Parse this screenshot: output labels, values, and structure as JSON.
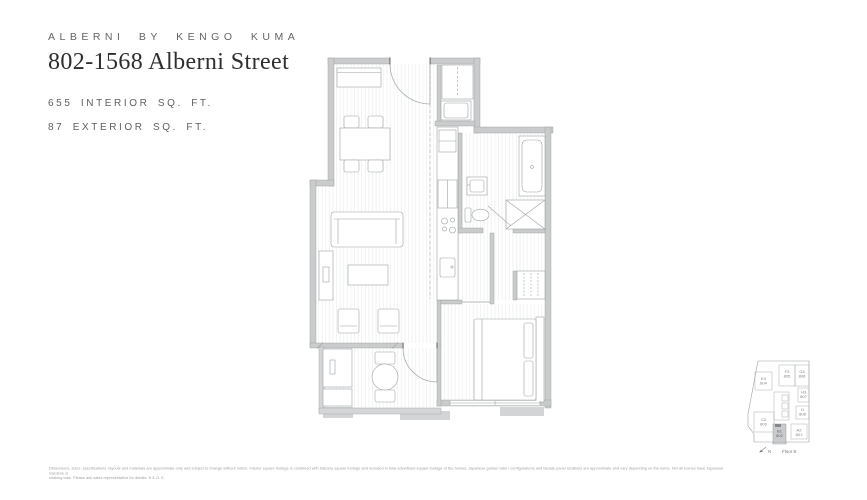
{
  "header": {
    "brand": "ALBERNI BY KENGO KUMA",
    "title": "802-1568 Alberni Street",
    "interior_sqft": "655 INTERIOR SQ. FT.",
    "exterior_sqft": "87 EXTERIOR SQ. FT."
  },
  "keyplan": {
    "north_label": "N",
    "floor_label": "Floor 8",
    "highlighted_unit": "B1 802",
    "units": [
      {
        "code": "E4",
        "number": "804"
      },
      {
        "code": "F3",
        "number": "805"
      },
      {
        "code": "G4",
        "number": "806"
      },
      {
        "code": "H3",
        "number": "807"
      },
      {
        "code": "I1",
        "number": "808"
      },
      {
        "code": "C2",
        "number": "803"
      },
      {
        "code": "B1",
        "number": "802"
      },
      {
        "code": "A2",
        "number": "801"
      }
    ]
  },
  "disclaimer": {
    "line1": "Dimensions, sizes, specifications, layouts and materials are approximate only and subject to change without notice. Interior square footage is combined with balcony square footage and included in total advertised square footage of the homes. Japanese garden tubs / configurations and facade panel locations are approximate and vary depending on the home. Not all homes have Japanese Gardens or",
    "line2": "soaking tubs. Please ask sales representative for details. E.& O. E."
  },
  "colors": {
    "wall": "#c9cbcc",
    "wall_stroke": "#9b9e9f",
    "furniture_line": "#9da2a5",
    "floor_hatch": "#e9ebeb",
    "title_text": "#2e2e2e",
    "label_text": "#5f5f5f",
    "keyplan_highlight": "#c9cbcd"
  }
}
